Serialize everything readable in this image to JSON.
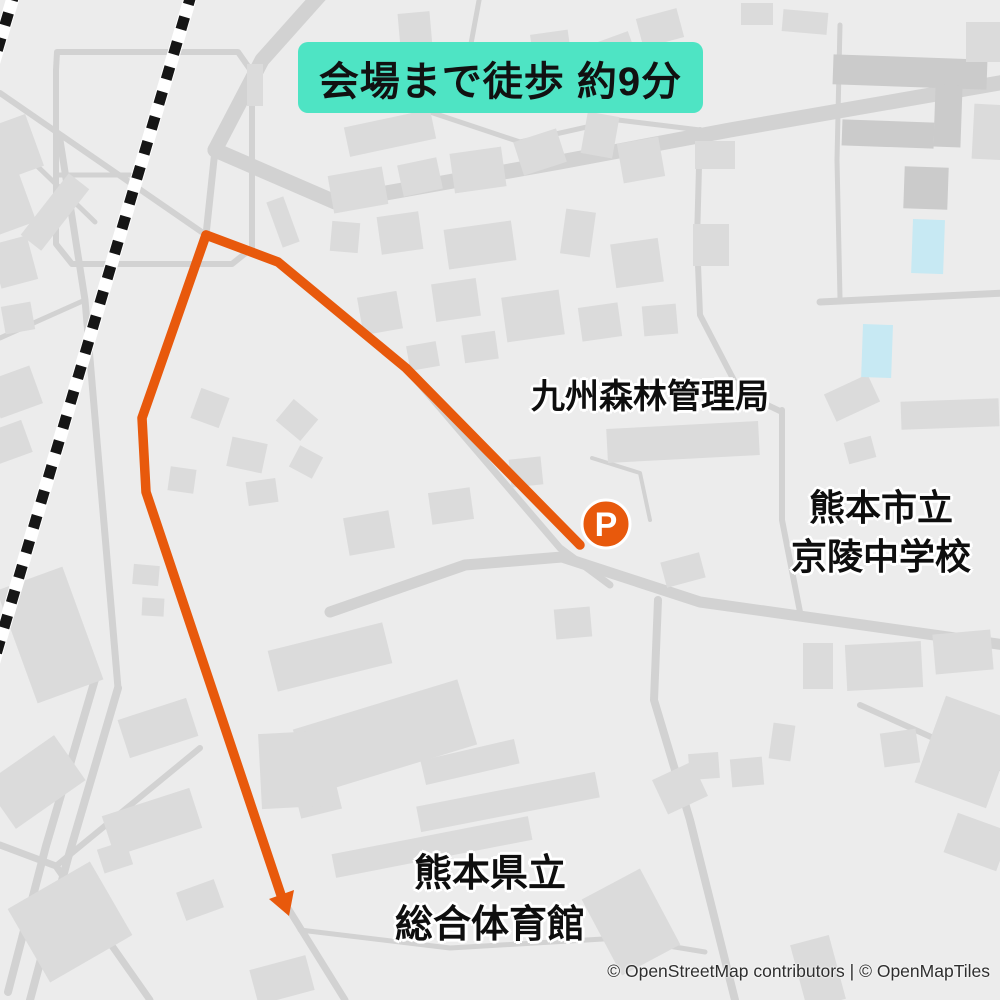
{
  "banner": {
    "text": "会場まで徒歩 約9分",
    "bg": "#4EE4C4",
    "fg": "#111111"
  },
  "labels": {
    "forestry": {
      "line1": "九州森林管理局"
    },
    "school": {
      "line1": "熊本市立",
      "line2": "京陵中学校"
    },
    "gym": {
      "line1": "熊本県立",
      "line2": "総合体育館"
    }
  },
  "marker": {
    "label": "P",
    "x": 606,
    "y": 524,
    "r": 24,
    "fill": "#E8590C",
    "ring": "#FFFFFF"
  },
  "attribution": {
    "text": "© OpenStreetMap contributors | © OpenMapTiles"
  },
  "map": {
    "bg": "#ECECEC",
    "road_color": "#D2D2D2",
    "building_color": "#DBDBDB",
    "building_dark": "#CBCBCB",
    "pool_color": "#C7E9F3",
    "railway": {
      "casing": "#FFFFFF",
      "dash_color": "#161616",
      "casing_width": 13,
      "dash_width": 11,
      "dash_pattern": "13 13",
      "lines": [
        [
          [
            192,
            -8
          ],
          [
            -8,
            668
          ]
        ],
        [
          [
            16,
            -12
          ],
          [
            -14,
            88
          ]
        ]
      ]
    },
    "roads": [
      {
        "pts": [
          [
            320,
            -5
          ],
          [
            262,
            60
          ],
          [
            215,
            150
          ]
        ],
        "w": 15
      },
      {
        "pts": [
          [
            215,
            150
          ],
          [
            335,
            202
          ],
          [
            560,
            162
          ],
          [
            730,
            130
          ],
          [
            1005,
            82
          ]
        ],
        "w": 15
      },
      {
        "pts": [
          [
            215,
            150
          ],
          [
            206,
            235
          ],
          [
            142,
            418
          ],
          [
            146,
            492
          ],
          [
            281,
            897
          ],
          [
            345,
            1000
          ]
        ],
        "w": 7
      },
      {
        "pts": [
          [
            206,
            235
          ],
          [
            278,
            262
          ],
          [
            406,
            368
          ],
          [
            560,
            548
          ],
          [
            610,
            585
          ]
        ],
        "w": 7
      },
      {
        "pts": [
          [
            330,
            612
          ],
          [
            465,
            565
          ],
          [
            562,
            557
          ],
          [
            700,
            602
          ],
          [
            1005,
            645
          ]
        ],
        "w": 11
      },
      {
        "pts": [
          [
            782,
            410
          ],
          [
            782,
            520
          ],
          [
            800,
            612
          ]
        ],
        "w": 6
      },
      {
        "pts": [
          [
            700,
            130
          ],
          [
            697,
            240
          ],
          [
            700,
            315
          ],
          [
            740,
            392
          ],
          [
            782,
            412
          ]
        ],
        "w": 6
      },
      {
        "pts": [
          [
            840,
            25
          ],
          [
            837,
            160
          ],
          [
            840,
            298
          ]
        ],
        "w": 5
      },
      {
        "pts": [
          [
            820,
            302
          ],
          [
            1005,
            293
          ]
        ],
        "w": 7
      },
      {
        "pts": [
          [
            118,
            688
          ],
          [
            68,
            858
          ],
          [
            30,
            1000
          ]
        ],
        "w": 8
      },
      {
        "pts": [
          [
            96,
            676
          ],
          [
            46,
            846
          ],
          [
            8,
            992
          ]
        ],
        "w": 8
      },
      {
        "pts": [
          [
            0,
            845
          ],
          [
            56,
            866
          ],
          [
            150,
            1000
          ]
        ],
        "w": 7
      },
      {
        "pts": [
          [
            56,
            866
          ],
          [
            200,
            748
          ]
        ],
        "w": 6
      },
      {
        "pts": [
          [
            658,
            600
          ],
          [
            654,
            700
          ],
          [
            690,
            820
          ],
          [
            735,
            1000
          ]
        ],
        "w": 8
      },
      {
        "pts": [
          [
            300,
            930
          ],
          [
            450,
            948
          ],
          [
            620,
            938
          ],
          [
            705,
            952
          ]
        ],
        "w": 5
      },
      {
        "pts": [
          [
            57,
            52
          ],
          [
            238,
            52
          ],
          [
            252,
            72
          ],
          [
            252,
            248
          ],
          [
            232,
            264
          ],
          [
            72,
            264
          ],
          [
            56,
            244
          ],
          [
            56,
            70
          ],
          [
            57,
            52
          ]
        ],
        "w": 6
      },
      {
        "pts": [
          [
            0,
            93
          ],
          [
            206,
            235
          ]
        ],
        "w": 6
      },
      {
        "pts": [
          [
            0,
            130
          ],
          [
            95,
            222
          ]
        ],
        "w": 5
      },
      {
        "pts": [
          [
            60,
            140
          ],
          [
            85,
            300
          ],
          [
            118,
            688
          ]
        ],
        "w": 7
      },
      {
        "pts": [
          [
            85,
            300
          ],
          [
            0,
            338
          ]
        ],
        "w": 5
      },
      {
        "pts": [
          [
            430,
            112
          ],
          [
            520,
            142
          ],
          [
            618,
            120
          ],
          [
            700,
            130
          ]
        ],
        "w": 5
      },
      {
        "pts": [
          [
            480,
            -5
          ],
          [
            468,
            60
          ],
          [
            430,
            112
          ]
        ],
        "w": 5
      },
      {
        "pts": [
          [
            592,
            458
          ],
          [
            640,
            473
          ],
          [
            650,
            520
          ]
        ],
        "w": 4
      },
      {
        "pts": [
          [
            860,
            705
          ],
          [
            1000,
            768
          ]
        ],
        "w": 6
      },
      {
        "pts": [
          [
            56,
            175
          ],
          [
            130,
            175
          ]
        ],
        "w": 5
      }
    ],
    "buildings": [
      [
        12,
        148,
        48,
        55,
        -20
      ],
      [
        8,
        205,
        42,
        50,
        -20
      ],
      [
        14,
        262,
        38,
        45,
        -15
      ],
      [
        55,
        212,
        78,
        26,
        -52
      ],
      [
        18,
        318,
        30,
        28,
        -10
      ],
      [
        15,
        392,
        45,
        40,
        -20
      ],
      [
        10,
        442,
        36,
        34,
        -20
      ],
      [
        50,
        635,
        70,
        120,
        -20
      ],
      [
        390,
        133,
        88,
        30,
        -12
      ],
      [
        465,
        80,
        55,
        45,
        -8
      ],
      [
        553,
        62,
        38,
        60,
        -8
      ],
      [
        612,
        55,
        46,
        34,
        -20
      ],
      [
        660,
        28,
        42,
        30,
        -15
      ],
      [
        415,
        30,
        32,
        35,
        -5
      ],
      [
        255,
        85,
        16,
        42,
        0
      ],
      [
        283,
        222,
        18,
        48,
        -20
      ],
      [
        358,
        190,
        55,
        38,
        -10
      ],
      [
        420,
        177,
        40,
        32,
        -12
      ],
      [
        478,
        170,
        52,
        40,
        -8
      ],
      [
        540,
        152,
        45,
        35,
        -18
      ],
      [
        600,
        135,
        32,
        42,
        10
      ],
      [
        641,
        160,
        42,
        40,
        -10
      ],
      [
        715,
        155,
        40,
        28,
        0
      ],
      [
        345,
        237,
        28,
        30,
        5
      ],
      [
        400,
        233,
        42,
        38,
        -8
      ],
      [
        480,
        245,
        68,
        40,
        -8
      ],
      [
        578,
        233,
        30,
        45,
        8
      ],
      [
        637,
        263,
        48,
        44,
        -8
      ],
      [
        711,
        245,
        36,
        42,
        0
      ],
      [
        380,
        313,
        40,
        38,
        -10
      ],
      [
        456,
        300,
        45,
        38,
        -8
      ],
      [
        533,
        316,
        58,
        45,
        -8
      ],
      [
        600,
        322,
        40,
        34,
        -8
      ],
      [
        660,
        320,
        34,
        30,
        -5
      ],
      [
        480,
        347,
        34,
        28,
        -8
      ],
      [
        423,
        356,
        30,
        25,
        -10
      ],
      [
        910,
        72,
        154,
        30,
        2,
        1
      ],
      [
        948,
        116,
        27,
        62,
        2,
        1
      ],
      [
        888,
        134,
        92,
        26,
        2,
        1
      ],
      [
        926,
        188,
        44,
        42,
        2,
        1
      ],
      [
        805,
        22,
        45,
        22,
        5
      ],
      [
        985,
        42,
        38,
        40,
        0
      ],
      [
        990,
        132,
        34,
        55,
        3
      ],
      [
        757,
        14,
        32,
        22,
        0
      ],
      [
        683,
        442,
        152,
        34,
        -3
      ],
      [
        852,
        398,
        48,
        30,
        -25
      ],
      [
        950,
        414,
        98,
        28,
        -2
      ],
      [
        860,
        450,
        28,
        22,
        -15
      ],
      [
        884,
        666,
        76,
        46,
        -3
      ],
      [
        963,
        652,
        58,
        40,
        -5
      ],
      [
        818,
        666,
        30,
        46,
        0
      ],
      [
        900,
        748,
        36,
        34,
        -8
      ],
      [
        948,
        752,
        26,
        22,
        12
      ],
      [
        966,
        752,
        76,
        92,
        20
      ],
      [
        977,
        842,
        56,
        42,
        20
      ],
      [
        631,
        922,
        66,
        86,
        -28
      ],
      [
        818,
        972,
        40,
        66,
        -15
      ],
      [
        747,
        772,
        32,
        28,
        -5
      ],
      [
        782,
        742,
        22,
        36,
        8
      ],
      [
        704,
        766,
        30,
        26,
        -4
      ],
      [
        680,
        788,
        44,
        38,
        -25
      ],
      [
        385,
        737,
        172,
        68,
        -17
      ],
      [
        330,
        657,
        118,
        42,
        -14
      ],
      [
        470,
        762,
        96,
        25,
        -13
      ],
      [
        508,
        802,
        182,
        26,
        -11
      ],
      [
        432,
        847,
        200,
        24,
        -11
      ],
      [
        318,
        799,
        42,
        30,
        -14
      ],
      [
        573,
        623,
        36,
        30,
        -5
      ],
      [
        35,
        782,
        85,
        55,
        -35
      ],
      [
        158,
        728,
        72,
        40,
        -18
      ],
      [
        152,
        822,
        92,
        42,
        -18
      ],
      [
        70,
        922,
        95,
        85,
        -30
      ],
      [
        291,
        770,
        62,
        75,
        -3
      ],
      [
        282,
        980,
        58,
        36,
        -15
      ],
      [
        200,
        900,
        40,
        30,
        -20
      ],
      [
        115,
        857,
        30,
        25,
        -18
      ],
      [
        210,
        408,
        30,
        32,
        20
      ],
      [
        247,
        455,
        36,
        30,
        12
      ],
      [
        297,
        420,
        32,
        28,
        40
      ],
      [
        182,
        480,
        26,
        24,
        8
      ],
      [
        262,
        492,
        30,
        24,
        -8
      ],
      [
        306,
        462,
        26,
        24,
        28
      ],
      [
        146,
        575,
        26,
        20,
        5
      ],
      [
        153,
        607,
        22,
        18,
        3
      ],
      [
        369,
        533,
        46,
        38,
        -10
      ],
      [
        451,
        506,
        42,
        32,
        -8
      ],
      [
        526,
        472,
        32,
        28,
        -6
      ],
      [
        683,
        570,
        40,
        26,
        -15
      ]
    ],
    "pools": [
      [
        913,
        219,
        32,
        54,
        2
      ],
      [
        863,
        324,
        30,
        53,
        2
      ]
    ],
    "route": {
      "color": "#E8590C",
      "width": 9.5,
      "branches": [
        [
          [
            206,
            235
          ],
          [
            142,
            418
          ],
          [
            146,
            492
          ],
          [
            281,
            895
          ]
        ],
        [
          [
            206,
            235
          ],
          [
            278,
            262
          ],
          [
            406,
            368
          ],
          [
            580,
            545
          ]
        ]
      ],
      "arrow": [
        [
          289,
          916
        ],
        [
          269,
          899
        ],
        [
          294,
          890
        ]
      ]
    }
  }
}
